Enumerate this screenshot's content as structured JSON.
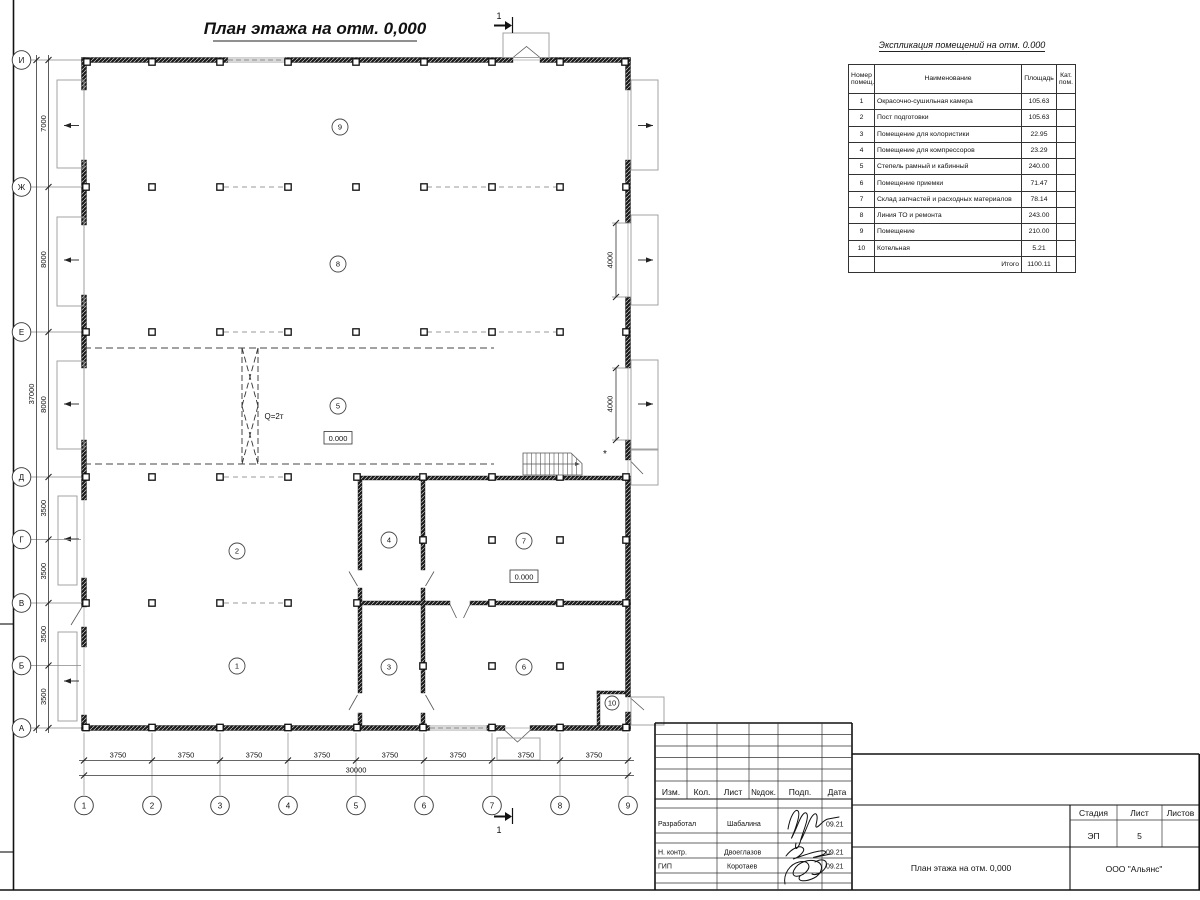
{
  "title": "План этажа на отм. 0,000",
  "explication": {
    "title": "Экспликация помещений на отм. 0.000",
    "headers": {
      "num": "Номер\nпомещ.",
      "name": "Наименование",
      "area": "Площадь",
      "cat": "Кат.\nпом."
    },
    "rows": [
      {
        "num": "1",
        "name": "Окрасочно-сушильная камера",
        "area": "105.63"
      },
      {
        "num": "2",
        "name": "Пост подготовки",
        "area": "105.63"
      },
      {
        "num": "3",
        "name": "Помещение для колористики",
        "area": "22.95"
      },
      {
        "num": "4",
        "name": "Помещение для компрессоров",
        "area": "23.29"
      },
      {
        "num": "5",
        "name": "Степель рамный и кабинный",
        "area": "240.00"
      },
      {
        "num": "6",
        "name": "Помещение приемки",
        "area": "71.47"
      },
      {
        "num": "7",
        "name": "Склад запчастей и расходных материалов",
        "area": "78.14"
      },
      {
        "num": "8",
        "name": "Линия ТО и ремонта",
        "area": "243.00"
      },
      {
        "num": "9",
        "name": "Помещение",
        "area": "210.00"
      },
      {
        "num": "10",
        "name": "Котельная",
        "area": "5.21"
      }
    ],
    "total_label": "Итого",
    "total_area": "1100.11"
  },
  "axes": {
    "vertical": [
      "И",
      "Ж",
      "Е",
      "Д",
      "Г",
      "В",
      "Б",
      "А"
    ],
    "horizontal": [
      "1",
      "2",
      "3",
      "4",
      "5",
      "6",
      "7",
      "8",
      "9"
    ]
  },
  "dims": {
    "bottom": [
      "3750",
      "3750",
      "3750",
      "3750",
      "3750",
      "3750",
      "3750",
      "3750"
    ],
    "bottom_total": "30000",
    "left": [
      "7000",
      "8000",
      "8000",
      "3500",
      "3500",
      "3500",
      "3500"
    ],
    "left_total": "37000",
    "right_gates": [
      "4000",
      "4000"
    ]
  },
  "plan": {
    "room_numbers": [
      "9",
      "8",
      "5",
      "2",
      "1",
      "4",
      "3",
      "7",
      "6",
      "10"
    ],
    "elevation": "0.000",
    "crane_label": "Q=2т",
    "section_mark": "1",
    "note_mark": "*"
  },
  "titleblock": {
    "headers": [
      "Изм.",
      "Кол.",
      "Лист",
      "№док.",
      "Подп.",
      "Дата"
    ],
    "signature_rows": [
      {
        "role": "Разработал",
        "name": "Шабалина",
        "date": "09.21"
      },
      {
        "role": "Н. контр.",
        "name": "Двоеглазов",
        "date": "09.21"
      },
      {
        "role": "ГИП",
        "name": "Коротаев",
        "date": "09.21"
      }
    ],
    "stage_label": "Стадия",
    "sheet_label": "Лист",
    "sheets_label": "Листов",
    "stage": "ЭП",
    "sheet_number": "5",
    "doc_title": "План этажа на отм. 0,000",
    "company": "ООО \"Альянс\""
  }
}
